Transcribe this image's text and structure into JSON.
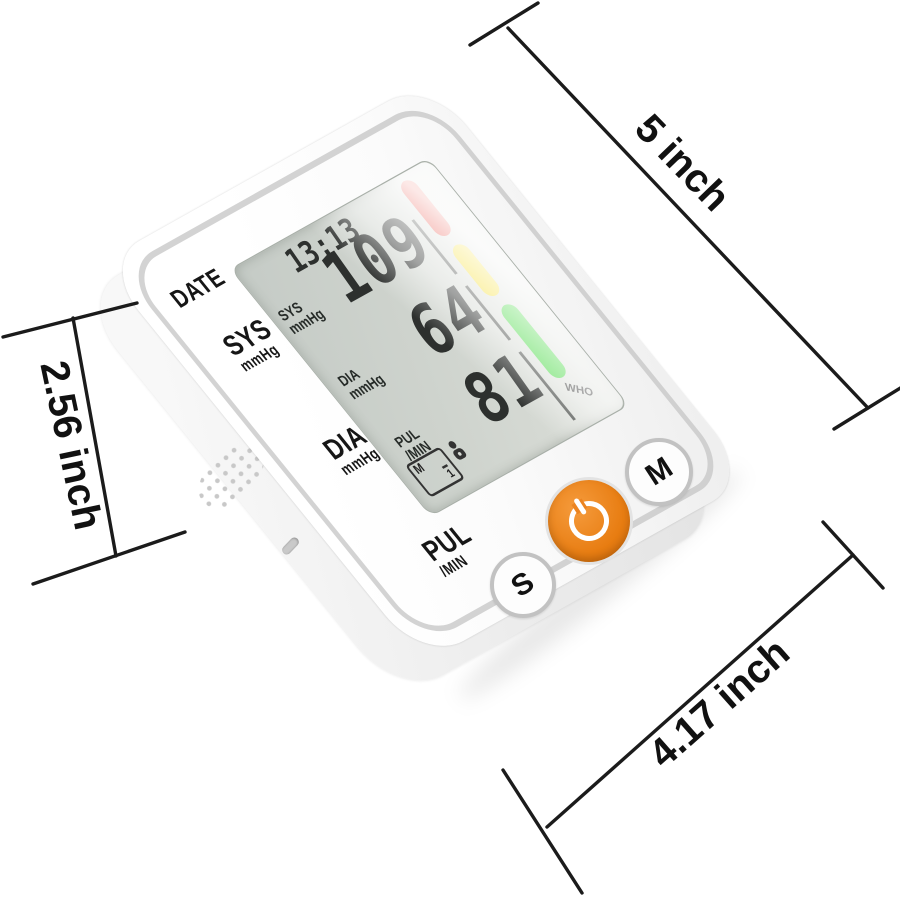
{
  "dims": {
    "width_label": "5 inch",
    "height_label": "2.56 inch",
    "depth_label": "4.17 inch"
  },
  "device": {
    "case_labels": {
      "date": "DATE",
      "sys": "SYS",
      "sys_unit": "mmHg",
      "dia": "DIA",
      "dia_unit": "mmHg",
      "pul": "PUL",
      "pul_unit": "/MIN"
    },
    "lcd": {
      "time": "13:13",
      "rows": [
        {
          "label": "SYS",
          "unit": "mmHg",
          "value": "109"
        },
        {
          "label": "DIA",
          "unit": "mmHg",
          "value": "64"
        },
        {
          "label": "PUL",
          "unit": "/MIN",
          "value": "81"
        }
      ],
      "memory": {
        "mode": "M",
        "slot": "1"
      },
      "who_label": "WHO"
    },
    "buttons": {
      "set_label": "S",
      "memory_label": "M"
    },
    "colors": {
      "bar_red": "#e11d0e",
      "bar_yellow": "#f3d80c",
      "bar_green": "#2fd32a",
      "power_orange": "#e87d12",
      "lcd_gray": "#ccd2cc"
    }
  }
}
